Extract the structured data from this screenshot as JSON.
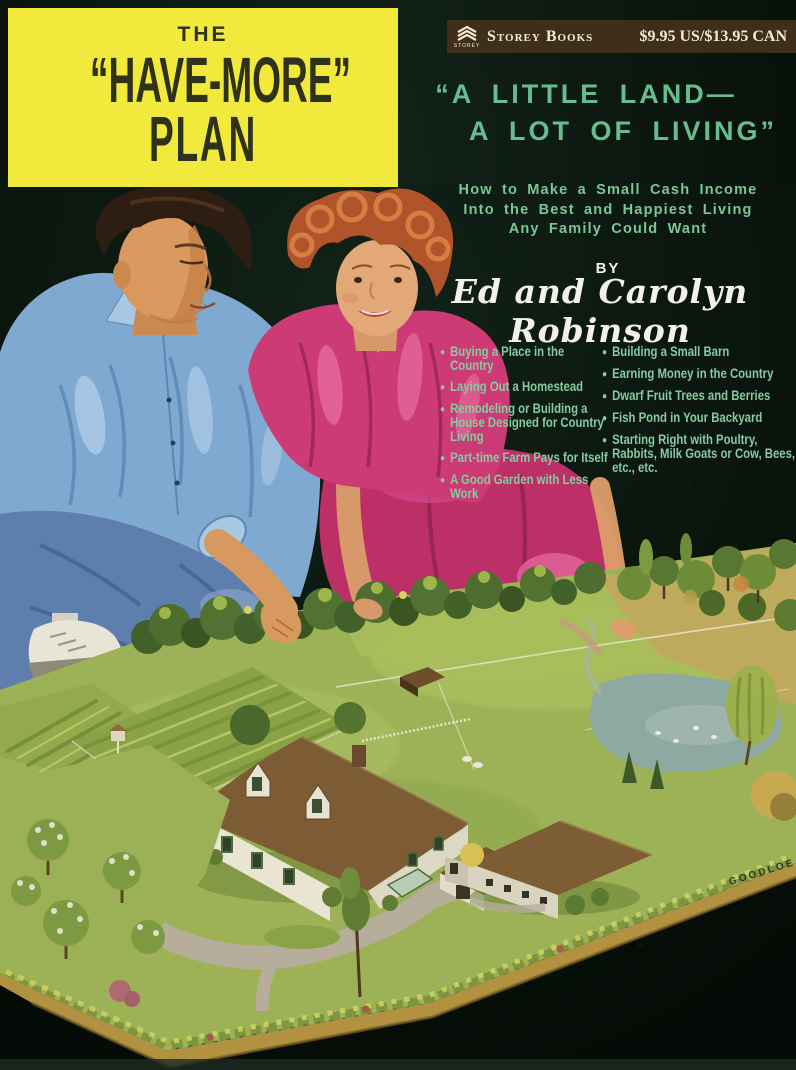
{
  "cover": {
    "background_color": "#0a150d",
    "title_box": {
      "background_color": "#f1e93c",
      "text_color": "#2f3118",
      "line1": "THE",
      "line2": "“HAVE-MORE”",
      "line3": "PLAN"
    },
    "publisher_bar": {
      "background_color": "#3e2e1a",
      "logo_caption": "STOREY",
      "publisher_name": "Storey Books",
      "price": "$9.95 US/$13.95 CAN"
    },
    "headline": {
      "color": "#68bd8e",
      "line1": "“A LITTLE LAND—",
      "line2": "A LOT OF LIVING”"
    },
    "subtitle": {
      "line1": "How to Make a Small Cash Income",
      "line2": "Into the Best and Happiest Living",
      "line3": "Any Family Could Want"
    },
    "byline": {
      "prefix": "BY",
      "authors": "Ed and Carolyn Robinson"
    },
    "topics": {
      "bullet": "●",
      "left": [
        "Buying a Place in the Country",
        "Laying Out a Homestead",
        "Remodeling or Building a House Designed for Country Living",
        "Part-time Farm Pays for Itself",
        "A Good Garden with Less Work"
      ],
      "right": [
        "Building a Small Barn",
        "Earning Money in the Country",
        "Dwarf Fruit Trees and Berries",
        "Fish Pond in Your Backyard",
        "Starting Right with Poultry, Rabbits, Milk Goats or Cow, Bees, etc., etc."
      ]
    },
    "illustration": {
      "artist_signature": "GOODLOE"
    }
  }
}
